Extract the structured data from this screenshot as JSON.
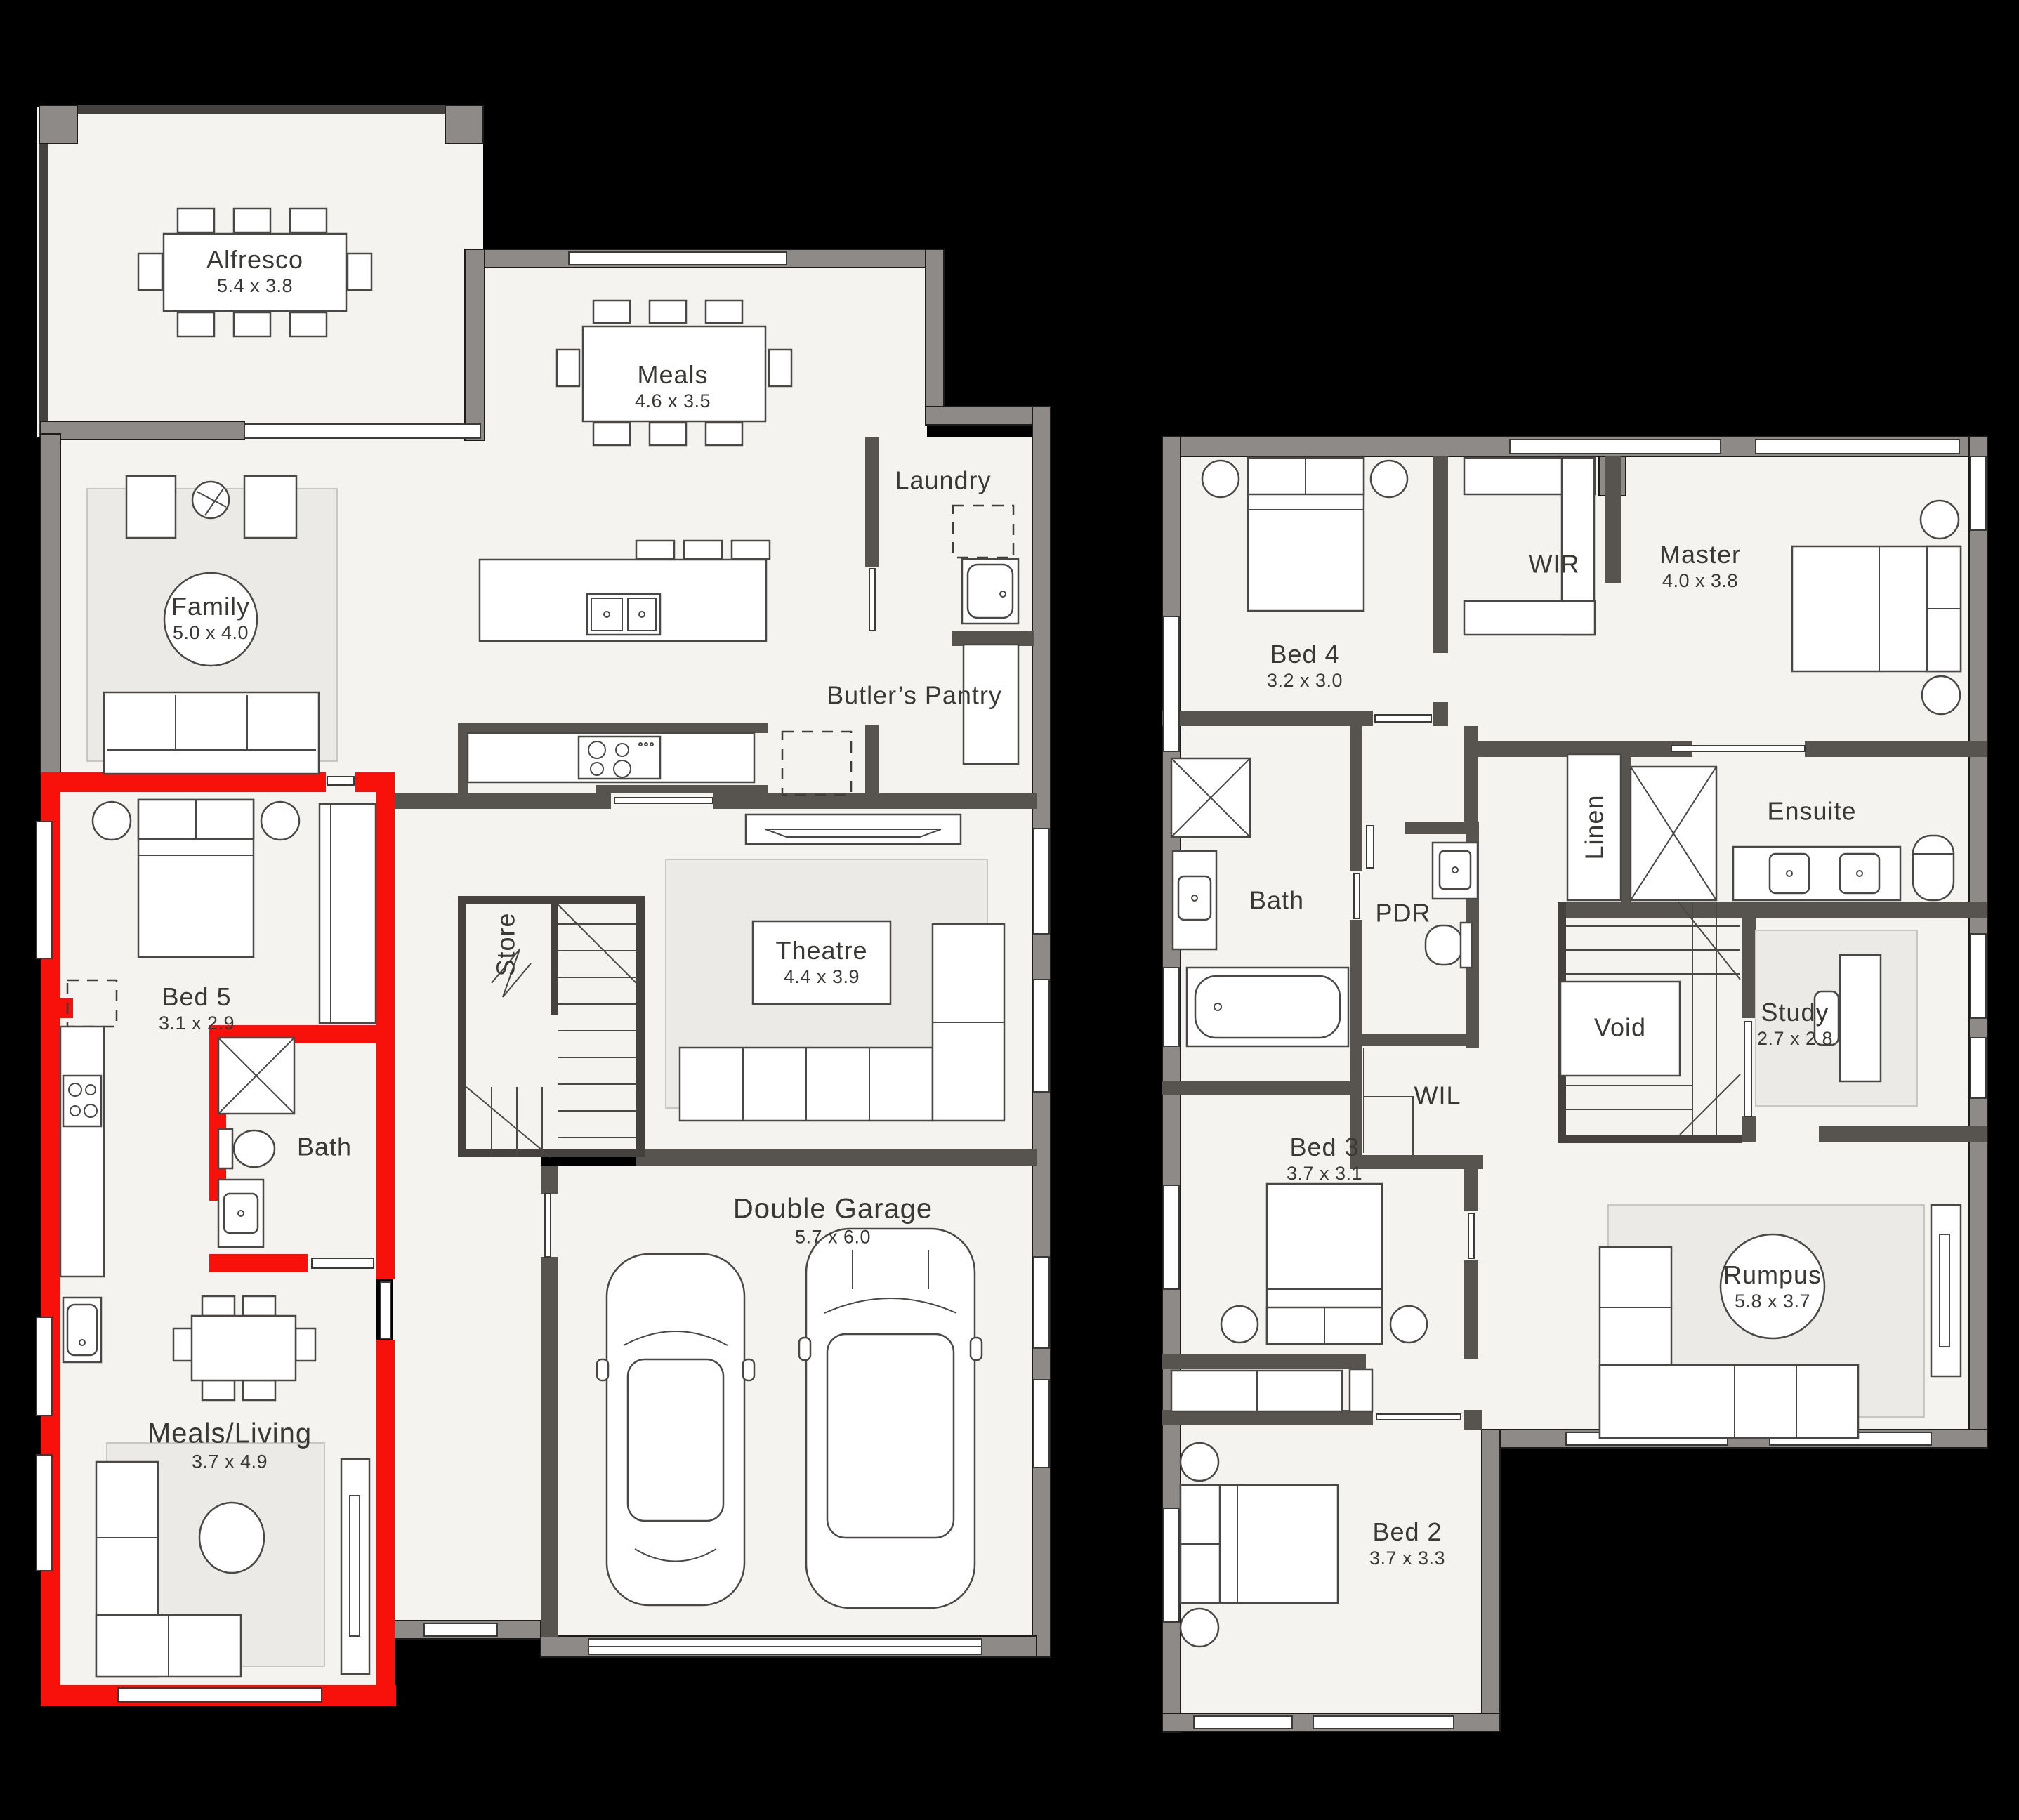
{
  "colors": {
    "background": "#000000",
    "floor": "#f5f3f0",
    "wall_exterior": "#8e8a88",
    "wall_interior": "#57534f",
    "highlight_red": "#f8100b"
  },
  "ground": {
    "rooms": [
      {
        "name": "Alfresco",
        "dims": "5.4 x 3.8"
      },
      {
        "name": "Meals",
        "dims": "4.6 x 3.5"
      },
      {
        "name": "Laundry",
        "dims": ""
      },
      {
        "name": "Family",
        "dims": "5.0 x 4.0"
      },
      {
        "name": "Butler’s Pantry",
        "dims": ""
      },
      {
        "name": "Bed 5",
        "dims": "3.1 x 2.9"
      },
      {
        "name": "Store",
        "dims": ""
      },
      {
        "name": "Bath",
        "dims": ""
      },
      {
        "name": "Theatre",
        "dims": "4.4 x 3.9"
      },
      {
        "name": "Double Garage",
        "dims": "5.7 x 6.0"
      },
      {
        "name": "Meals/Living",
        "dims": "3.7 x 4.9"
      }
    ]
  },
  "first": {
    "rooms": [
      {
        "name": "Bed 4",
        "dims": "3.2 x 3.0"
      },
      {
        "name": "WIR",
        "dims": ""
      },
      {
        "name": "Master",
        "dims": "4.0 x 3.8"
      },
      {
        "name": "Linen",
        "dims": ""
      },
      {
        "name": "Ensuite",
        "dims": ""
      },
      {
        "name": "Bath",
        "dims": ""
      },
      {
        "name": "PDR",
        "dims": ""
      },
      {
        "name": "WIL",
        "dims": ""
      },
      {
        "name": "Void",
        "dims": ""
      },
      {
        "name": "Study",
        "dims": "2.7 x 2.8"
      },
      {
        "name": "Bed 3",
        "dims": "3.7 x 3.1"
      },
      {
        "name": "Rumpus",
        "dims": "5.8 x 3.7"
      },
      {
        "name": "Bed 2",
        "dims": "3.7 x 3.3"
      }
    ]
  }
}
